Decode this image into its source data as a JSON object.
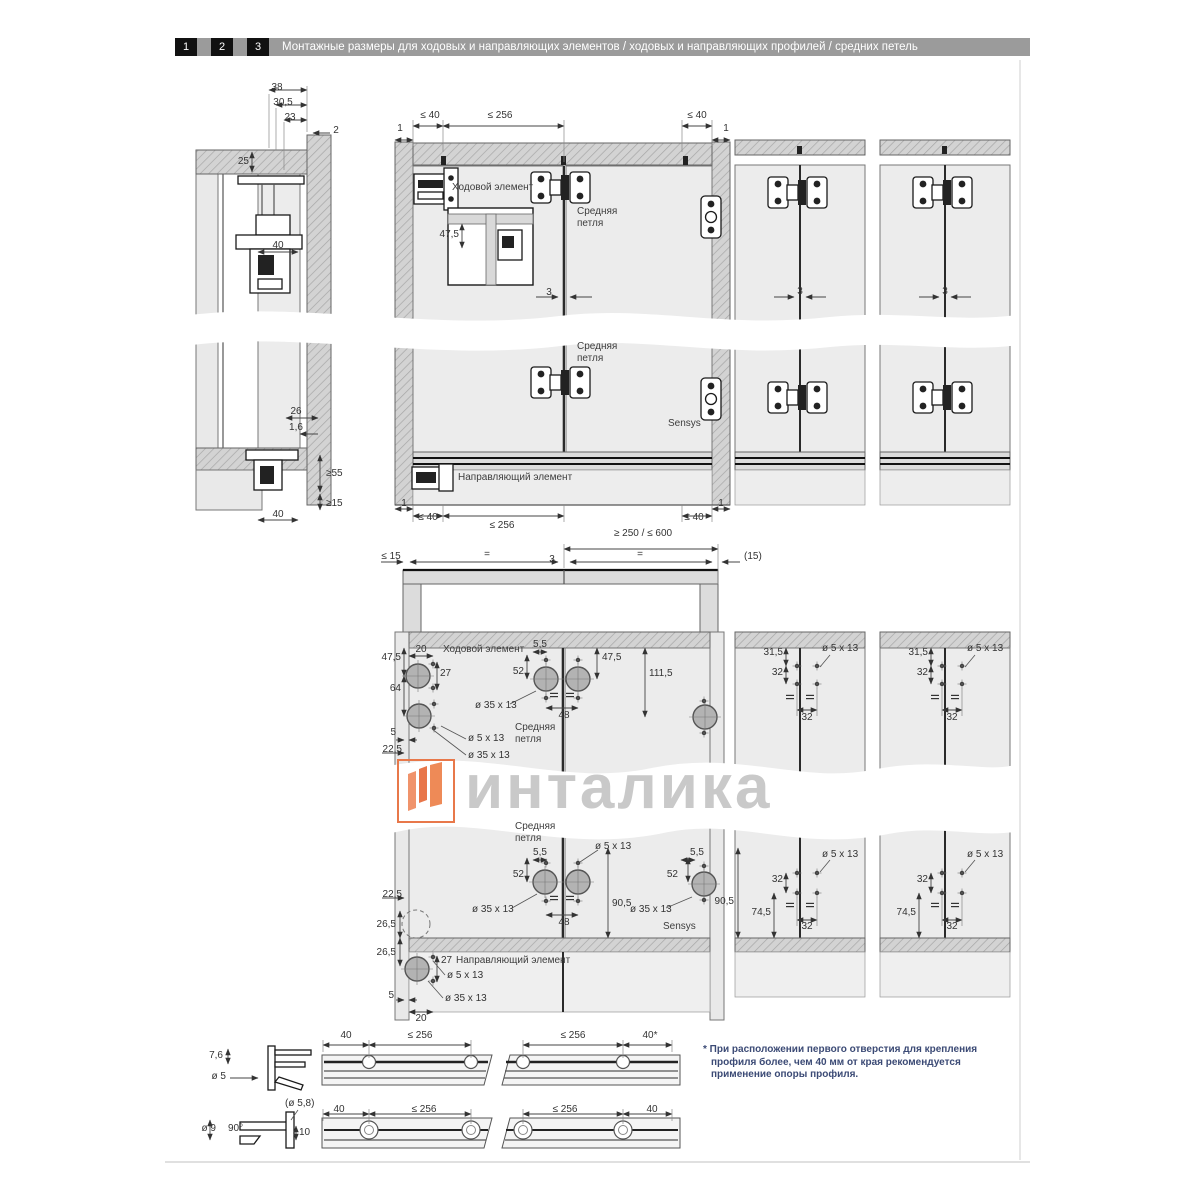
{
  "header": {
    "steps": [
      "1",
      "2",
      "3"
    ],
    "title": "Монтажные размеры для ходовых и направляющих элементов / ходовых и направляющих профилей / средних петель"
  },
  "labels": {
    "running_element": "Ходовой элемент",
    "guide_element": "Направляющий элемент",
    "middle_hinge": "Средняя\nпетля",
    "sensys": "Sensys"
  },
  "dims": {
    "d38": "38",
    "d30_5": "30,5",
    "d23": "23",
    "d2": "2",
    "d25": "25",
    "d40": "40",
    "d26": "26",
    "d1_6": "1,6",
    "ge55": "≥55",
    "ge15": "≥15",
    "le40": "≤ 40",
    "le256": "≤ 256",
    "d1": "1",
    "d3": "3",
    "d47_5": "47,5",
    "range": "≥ 250 / ≤ 600",
    "le15": "≤ 15",
    "eq": "=",
    "p15": "(15)",
    "d20": "20",
    "d27": "27",
    "d64": "64",
    "d5": "5",
    "d22_5": "22,5",
    "d5_5": "5,5",
    "d52": "52",
    "d48": "48",
    "d111_5": "111,5",
    "d31_5": "31,5",
    "d32": "32",
    "d90_5": "90,5",
    "d74_5": "74,5",
    "d26_5": "26,5",
    "d7_6": "7,6",
    "dia5": "ø 5",
    "d40star": "40*",
    "dia5_8": "(ø 5,8)",
    "dia9": "ø 9",
    "deg90": "90°",
    "d10": "10",
    "hole5": "ø 5 x 13",
    "hole35": "ø 35 x 13"
  },
  "watermark": {
    "text": "инталика",
    "logo_color": "#e8784a"
  },
  "footnote": {
    "marker": "*",
    "text": " При расположении первого отверстия для крепления профиля более, чем 40 мм от края рекомендуется применение опоры профиля."
  }
}
